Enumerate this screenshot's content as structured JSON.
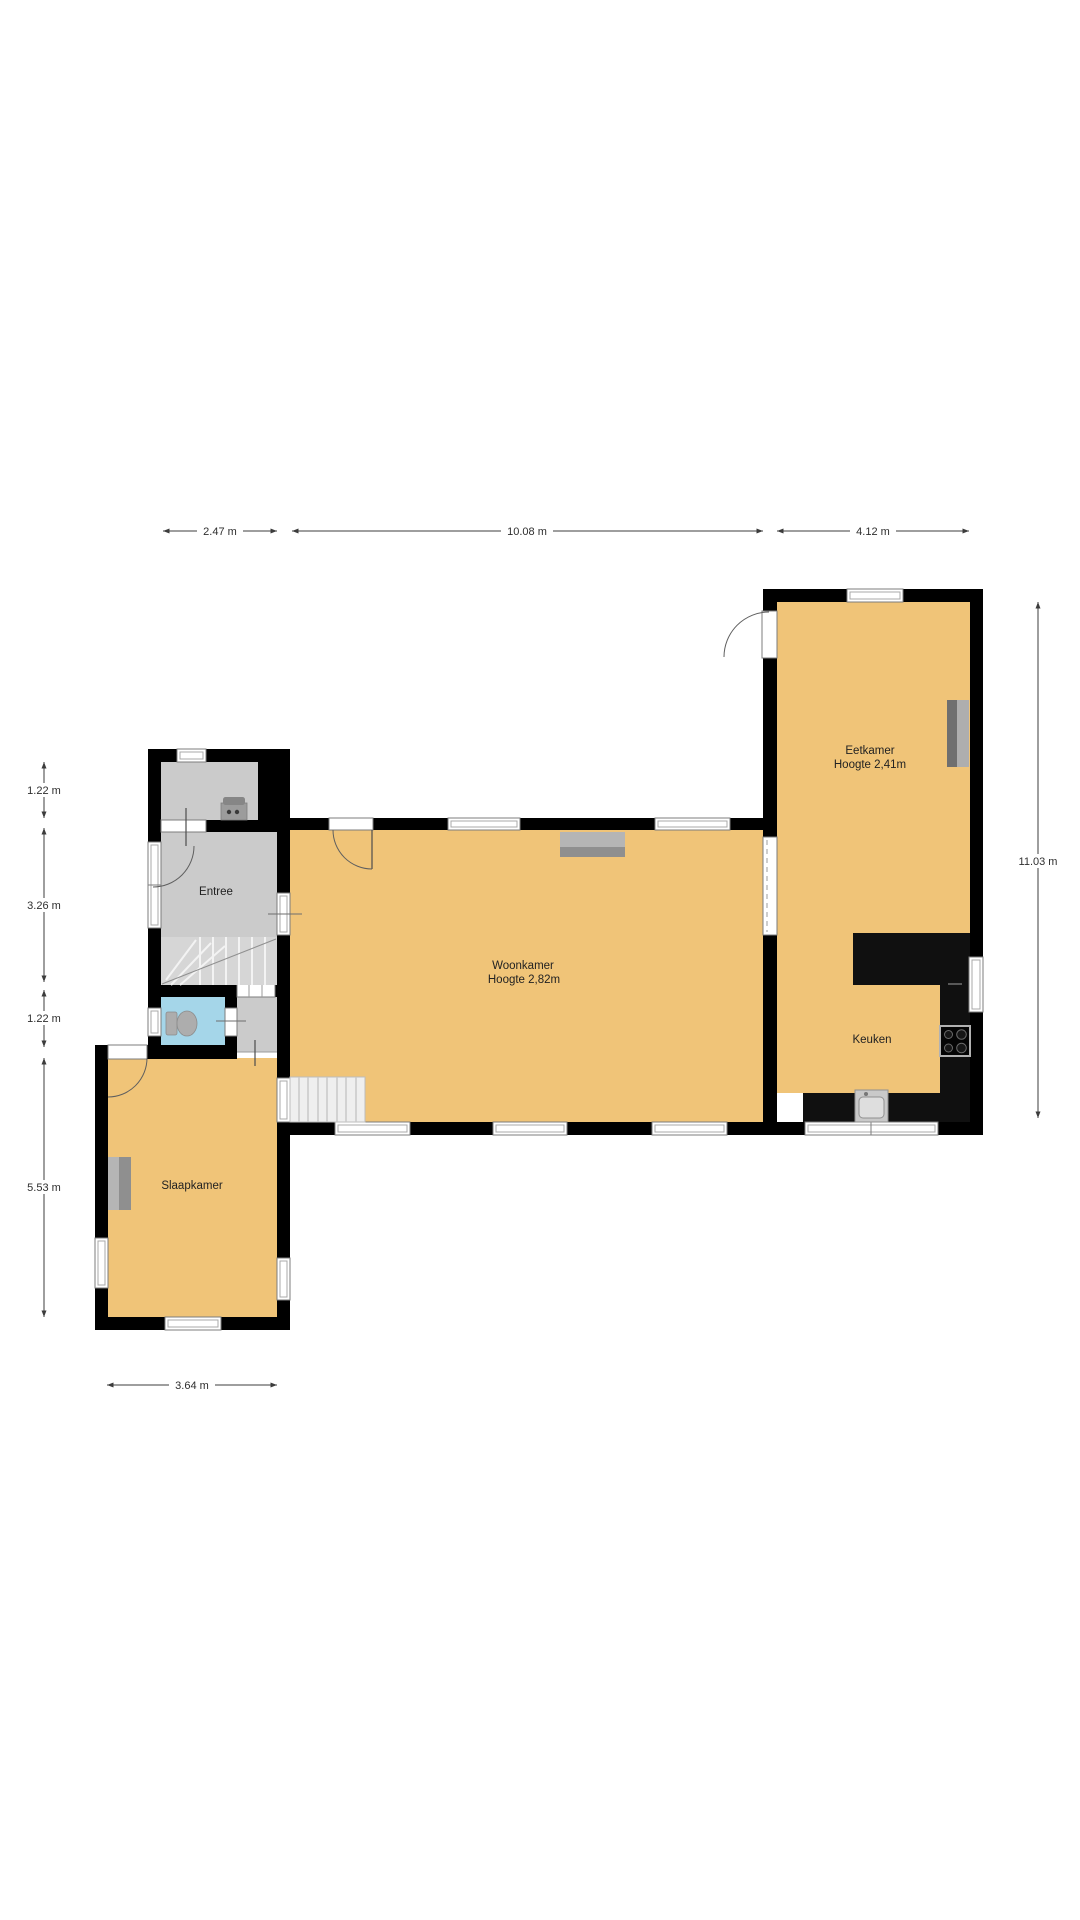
{
  "rooms": {
    "eetkamer": {
      "label": "Eetkamer",
      "height": "Hoogte 2,41m"
    },
    "woonkamer": {
      "label": "Woonkamer",
      "height": "Hoogte 2,82m"
    },
    "keuken": {
      "label": "Keuken"
    },
    "entree": {
      "label": "Entree"
    },
    "slaapkamer": {
      "label": "Slaapkamer"
    }
  },
  "dimensions": {
    "top": [
      "2.47 m",
      "10.08 m",
      "4.12 m"
    ],
    "left": [
      "1.22 m",
      "3.26 m",
      "1.22 m",
      "5.53 m"
    ],
    "right": [
      "11.03 m"
    ],
    "bottom": [
      "3.64 m"
    ]
  },
  "colors": {
    "floor": "#f0c478",
    "wall": "#000000",
    "roomgray": "#cbcbcb",
    "wet": "#a5d6e9",
    "counter": "#101010",
    "dim": "#3c3c3c",
    "label": "#222222"
  }
}
